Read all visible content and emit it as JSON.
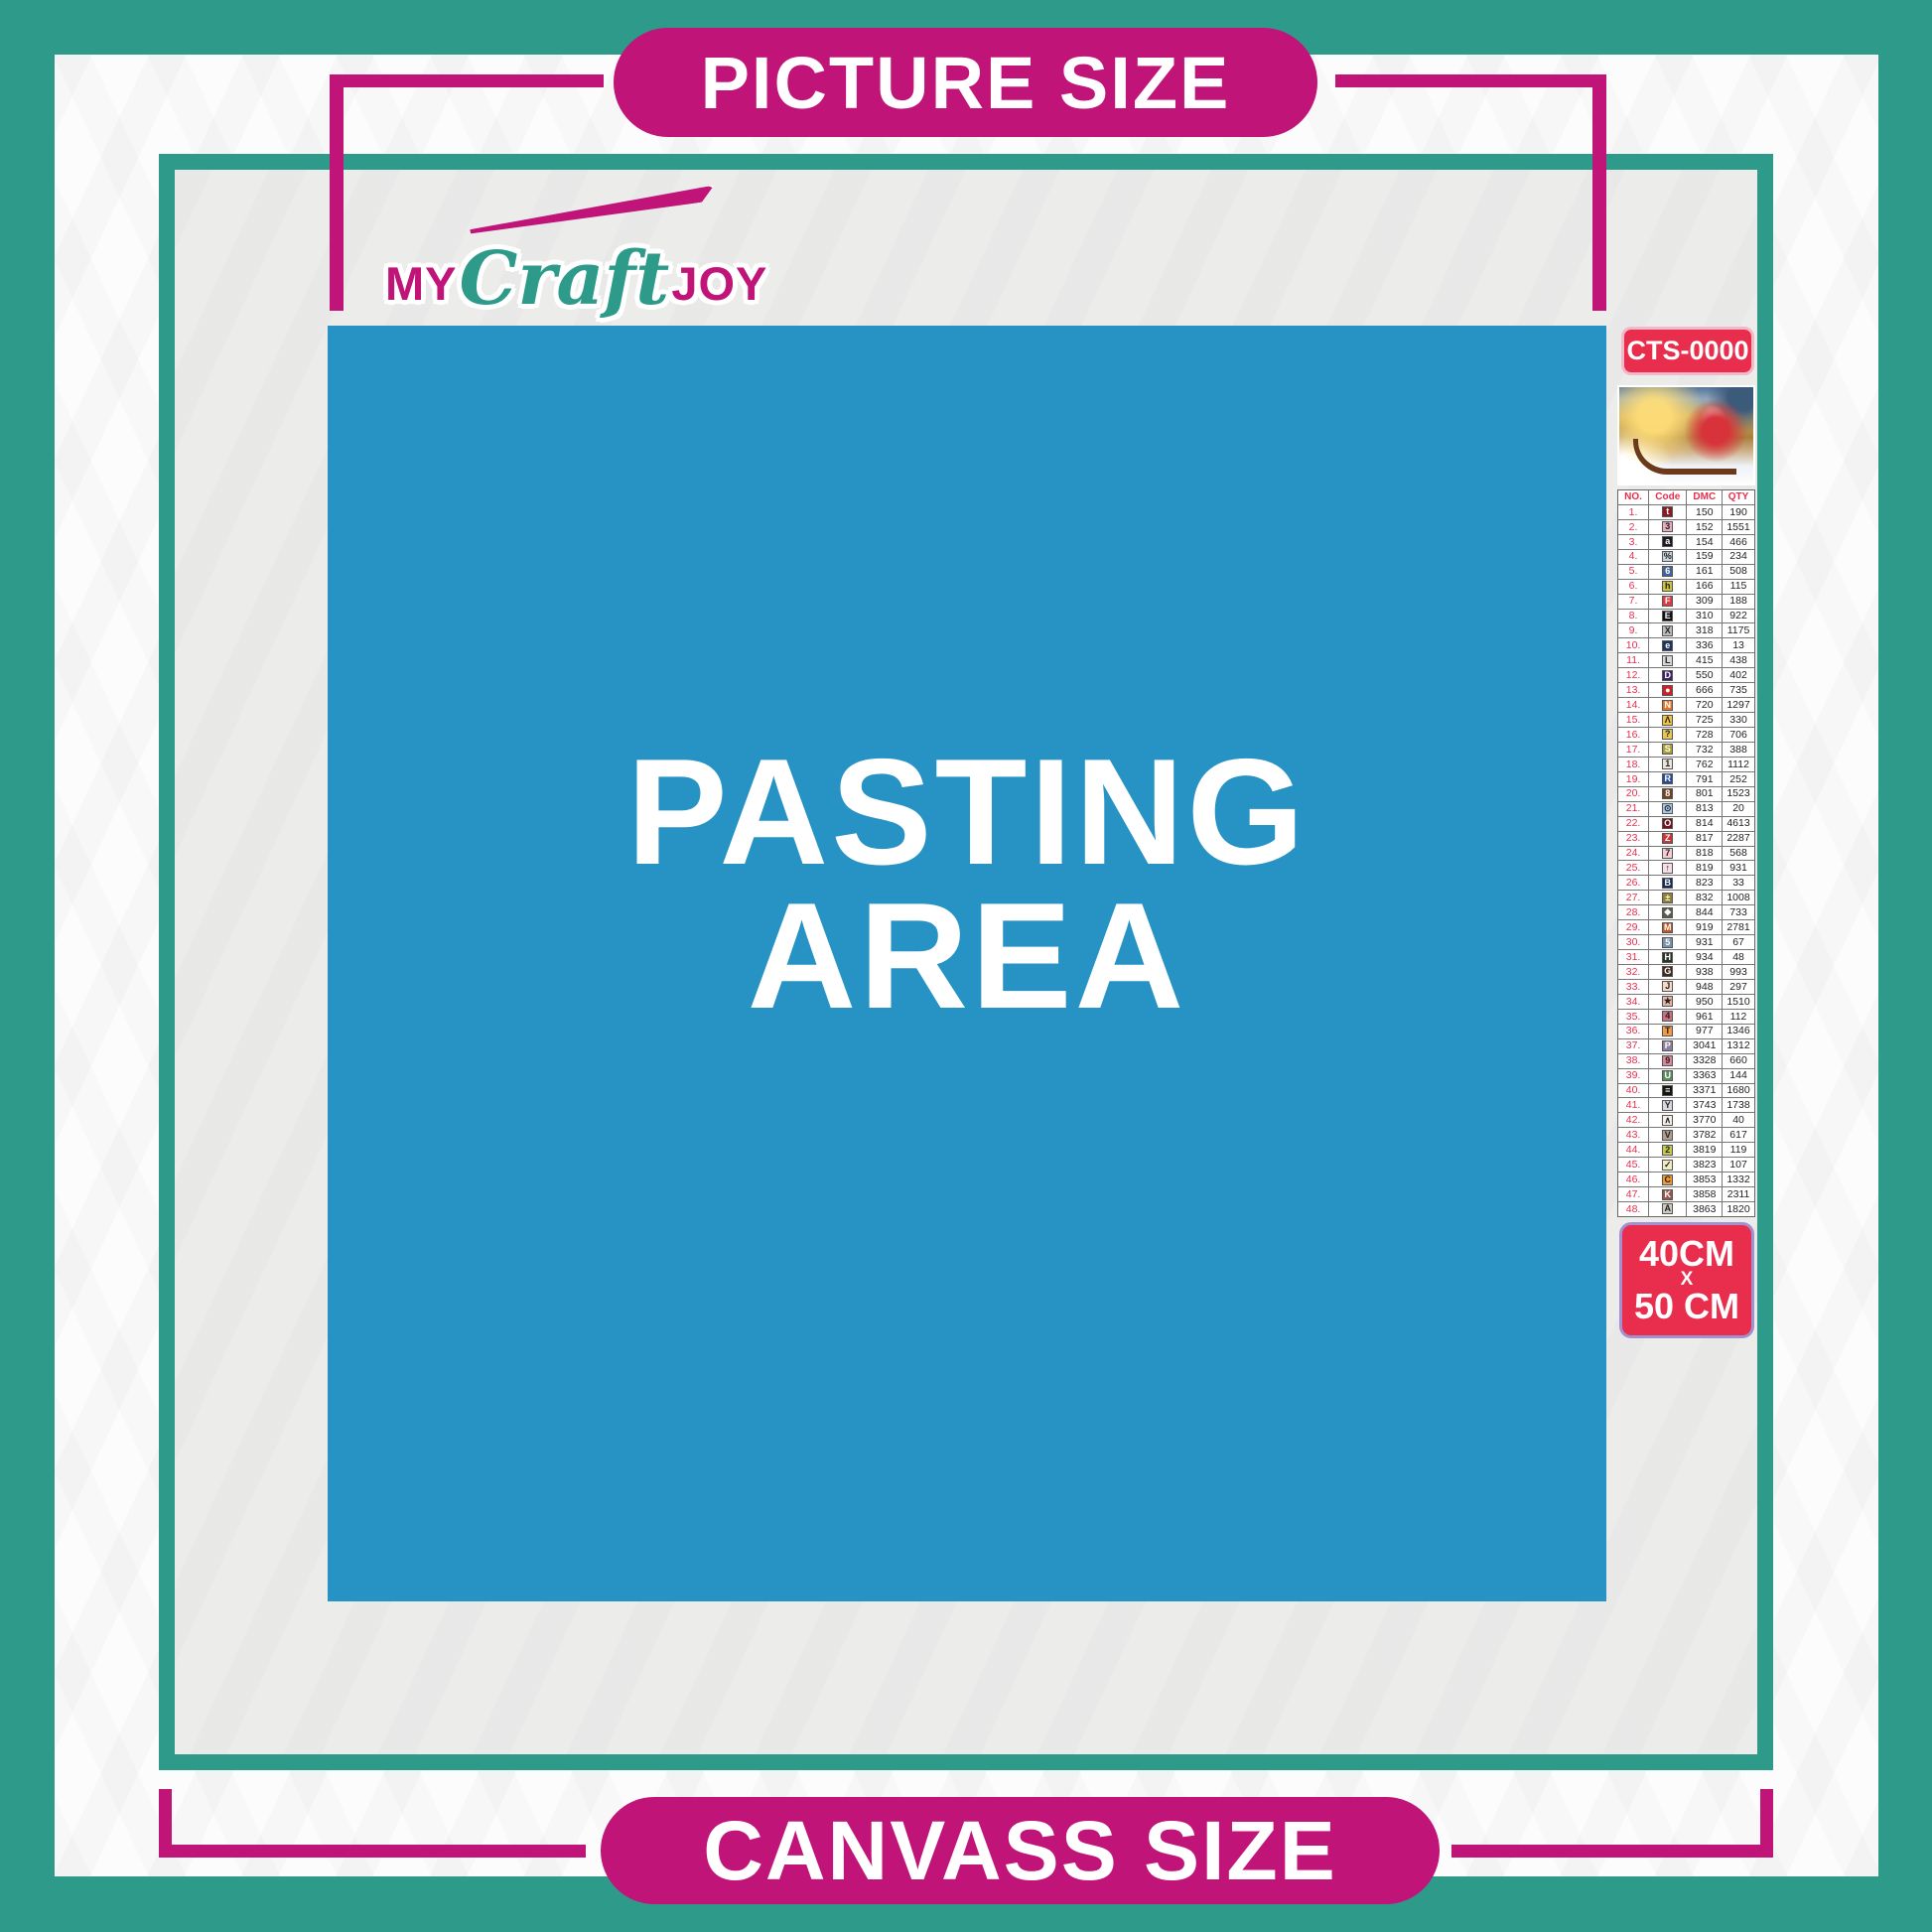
{
  "colors": {
    "teal": "#2e9a8a",
    "magenta": "#c01478",
    "blue": "#2793c5",
    "red": "#e92e4d"
  },
  "banners": {
    "top": "PICTURE SIZE",
    "bottom": "CANVASS SIZE"
  },
  "logo": {
    "part1": "MY",
    "part2": "Craft",
    "part3": "JOY"
  },
  "pasting_area": {
    "line1": "PASTING",
    "line2": "AREA"
  },
  "product": {
    "code": "CTS-0000",
    "thumbnail": "santa-claus-sleigh-christmas-scene",
    "size_line1": "40CM",
    "size_line2": "X",
    "size_line3": "50 CM"
  },
  "legend": {
    "headers": [
      "NO.",
      "Code",
      "DMC",
      "QTY"
    ],
    "rows": [
      {
        "no": "1.",
        "sym": "t",
        "bg": "#8b1a24",
        "fg": "#ffffff",
        "dmc": "150",
        "qty": "190"
      },
      {
        "no": "2.",
        "sym": "3",
        "bg": "#e9aebc",
        "fg": "#222222",
        "dmc": "152",
        "qty": "1551"
      },
      {
        "no": "3.",
        "sym": "a",
        "bg": "#1a1a1f",
        "fg": "#ffffff",
        "dmc": "154",
        "qty": "466"
      },
      {
        "no": "4.",
        "sym": "%",
        "bg": "#c7d3dd",
        "fg": "#222222",
        "dmc": "159",
        "qty": "234"
      },
      {
        "no": "5.",
        "sym": "6",
        "bg": "#41639b",
        "fg": "#ffffff",
        "dmc": "161",
        "qty": "508"
      },
      {
        "no": "6.",
        "sym": "h",
        "bg": "#c9c33d",
        "fg": "#222222",
        "dmc": "166",
        "qty": "115"
      },
      {
        "no": "7.",
        "sym": "F",
        "bg": "#da3b45",
        "fg": "#ffffff",
        "dmc": "309",
        "qty": "188"
      },
      {
        "no": "8.",
        "sym": "E",
        "bg": "#0f0f12",
        "fg": "#ffffff",
        "dmc": "310",
        "qty": "922"
      },
      {
        "no": "9.",
        "sym": "X",
        "bg": "#b8babd",
        "fg": "#222222",
        "dmc": "318",
        "qty": "1175"
      },
      {
        "no": "10.",
        "sym": "e",
        "bg": "#1f3460",
        "fg": "#ffffff",
        "dmc": "336",
        "qty": "13"
      },
      {
        "no": "11.",
        "sym": "L",
        "bg": "#d6d6d4",
        "fg": "#222222",
        "dmc": "415",
        "qty": "438"
      },
      {
        "no": "12.",
        "sym": "D",
        "bg": "#3d2364",
        "fg": "#ffffff",
        "dmc": "550",
        "qty": "402"
      },
      {
        "no": "13.",
        "sym": "●",
        "bg": "#d02027",
        "fg": "#ffffff",
        "dmc": "666",
        "qty": "735"
      },
      {
        "no": "14.",
        "sym": "N",
        "bg": "#e3772c",
        "fg": "#ffffff",
        "dmc": "720",
        "qty": "1297"
      },
      {
        "no": "15.",
        "sym": "Λ",
        "bg": "#f2c33e",
        "fg": "#222222",
        "dmc": "725",
        "qty": "330"
      },
      {
        "no": "16.",
        "sym": "?",
        "bg": "#e8c654",
        "fg": "#222222",
        "dmc": "728",
        "qty": "706"
      },
      {
        "no": "17.",
        "sym": "S",
        "bg": "#a9a134",
        "fg": "#ffffff",
        "dmc": "732",
        "qty": "388"
      },
      {
        "no": "18.",
        "sym": "1",
        "bg": "#e9e4de",
        "fg": "#222222",
        "dmc": "762",
        "qty": "1112"
      },
      {
        "no": "19.",
        "sym": "R",
        "bg": "#2c4b95",
        "fg": "#ffffff",
        "dmc": "791",
        "qty": "252"
      },
      {
        "no": "20.",
        "sym": "8",
        "bg": "#6f4324",
        "fg": "#ffffff",
        "dmc": "801",
        "qty": "1523"
      },
      {
        "no": "21.",
        "sym": "⊙",
        "bg": "#a7c7e7",
        "fg": "#222222",
        "dmc": "813",
        "qty": "20"
      },
      {
        "no": "22.",
        "sym": "O",
        "bg": "#6f1521",
        "fg": "#ffffff",
        "dmc": "814",
        "qty": "4613"
      },
      {
        "no": "23.",
        "sym": "Z",
        "bg": "#c63639",
        "fg": "#ffffff",
        "dmc": "817",
        "qty": "2287"
      },
      {
        "no": "24.",
        "sym": "7",
        "bg": "#f4cad3",
        "fg": "#222222",
        "dmc": "818",
        "qty": "568"
      },
      {
        "no": "25.",
        "sym": "↑",
        "bg": "#f7dee3",
        "fg": "#222222",
        "dmc": "819",
        "qty": "931"
      },
      {
        "no": "26.",
        "sym": "B",
        "bg": "#162a5b",
        "fg": "#ffffff",
        "dmc": "823",
        "qty": "33"
      },
      {
        "no": "27.",
        "sym": "±",
        "bg": "#90802f",
        "fg": "#ffffff",
        "dmc": "832",
        "qty": "1008"
      },
      {
        "no": "28.",
        "sym": "❖",
        "bg": "#595a50",
        "fg": "#ffffff",
        "dmc": "844",
        "qty": "733"
      },
      {
        "no": "29.",
        "sym": "M",
        "bg": "#c05526",
        "fg": "#ffffff",
        "dmc": "919",
        "qty": "2781"
      },
      {
        "no": "30.",
        "sym": "5",
        "bg": "#7492a8",
        "fg": "#ffffff",
        "dmc": "931",
        "qty": "67"
      },
      {
        "no": "31.",
        "sym": "H",
        "bg": "#28342a",
        "fg": "#ffffff",
        "dmc": "934",
        "qty": "48"
      },
      {
        "no": "32.",
        "sym": "G",
        "bg": "#41291c",
        "fg": "#ffffff",
        "dmc": "938",
        "qty": "993"
      },
      {
        "no": "33.",
        "sym": "J",
        "bg": "#f6dac5",
        "fg": "#222222",
        "dmc": "948",
        "qty": "297"
      },
      {
        "no": "34.",
        "sym": "★",
        "bg": "#e6b5a3",
        "fg": "#222222",
        "dmc": "950",
        "qty": "1510"
      },
      {
        "no": "35.",
        "sym": "4",
        "bg": "#ca7080",
        "fg": "#222222",
        "dmc": "961",
        "qty": "112"
      },
      {
        "no": "36.",
        "sym": "T",
        "bg": "#ef9c44",
        "fg": "#222222",
        "dmc": "977",
        "qty": "1346"
      },
      {
        "no": "37.",
        "sym": "P",
        "bg": "#8d7f9d",
        "fg": "#ffffff",
        "dmc": "3041",
        "qty": "1312"
      },
      {
        "no": "38.",
        "sym": "9",
        "bg": "#da8896",
        "fg": "#222222",
        "dmc": "3328",
        "qty": "660"
      },
      {
        "no": "39.",
        "sym": "U",
        "bg": "#5e8b5f",
        "fg": "#ffffff",
        "dmc": "3363",
        "qty": "144"
      },
      {
        "no": "40.",
        "sym": "≡",
        "bg": "#181410",
        "fg": "#ffffff",
        "dmc": "3371",
        "qty": "1680"
      },
      {
        "no": "41.",
        "sym": "Y",
        "bg": "#d9d7e3",
        "fg": "#222222",
        "dmc": "3743",
        "qty": "1738"
      },
      {
        "no": "42.",
        "sym": "∧",
        "bg": "#f4f0e7",
        "fg": "#222222",
        "dmc": "3770",
        "qty": "40"
      },
      {
        "no": "43.",
        "sym": "V",
        "bg": "#ae9f8e",
        "fg": "#222222",
        "dmc": "3782",
        "qty": "617"
      },
      {
        "no": "44.",
        "sym": "2",
        "bg": "#c6ca4b",
        "fg": "#222222",
        "dmc": "3819",
        "qty": "119"
      },
      {
        "no": "45.",
        "sym": "✓",
        "bg": "#f2edc1",
        "fg": "#222222",
        "dmc": "3823",
        "qty": "107"
      },
      {
        "no": "46.",
        "sym": "C",
        "bg": "#eb9b34",
        "fg": "#222222",
        "dmc": "3853",
        "qty": "1332"
      },
      {
        "no": "47.",
        "sym": "K",
        "bg": "#96574b",
        "fg": "#ffffff",
        "dmc": "3858",
        "qty": "2311"
      },
      {
        "no": "48.",
        "sym": "A",
        "bg": "#d0cabe",
        "fg": "#222222",
        "dmc": "3863",
        "qty": "1820"
      }
    ]
  }
}
